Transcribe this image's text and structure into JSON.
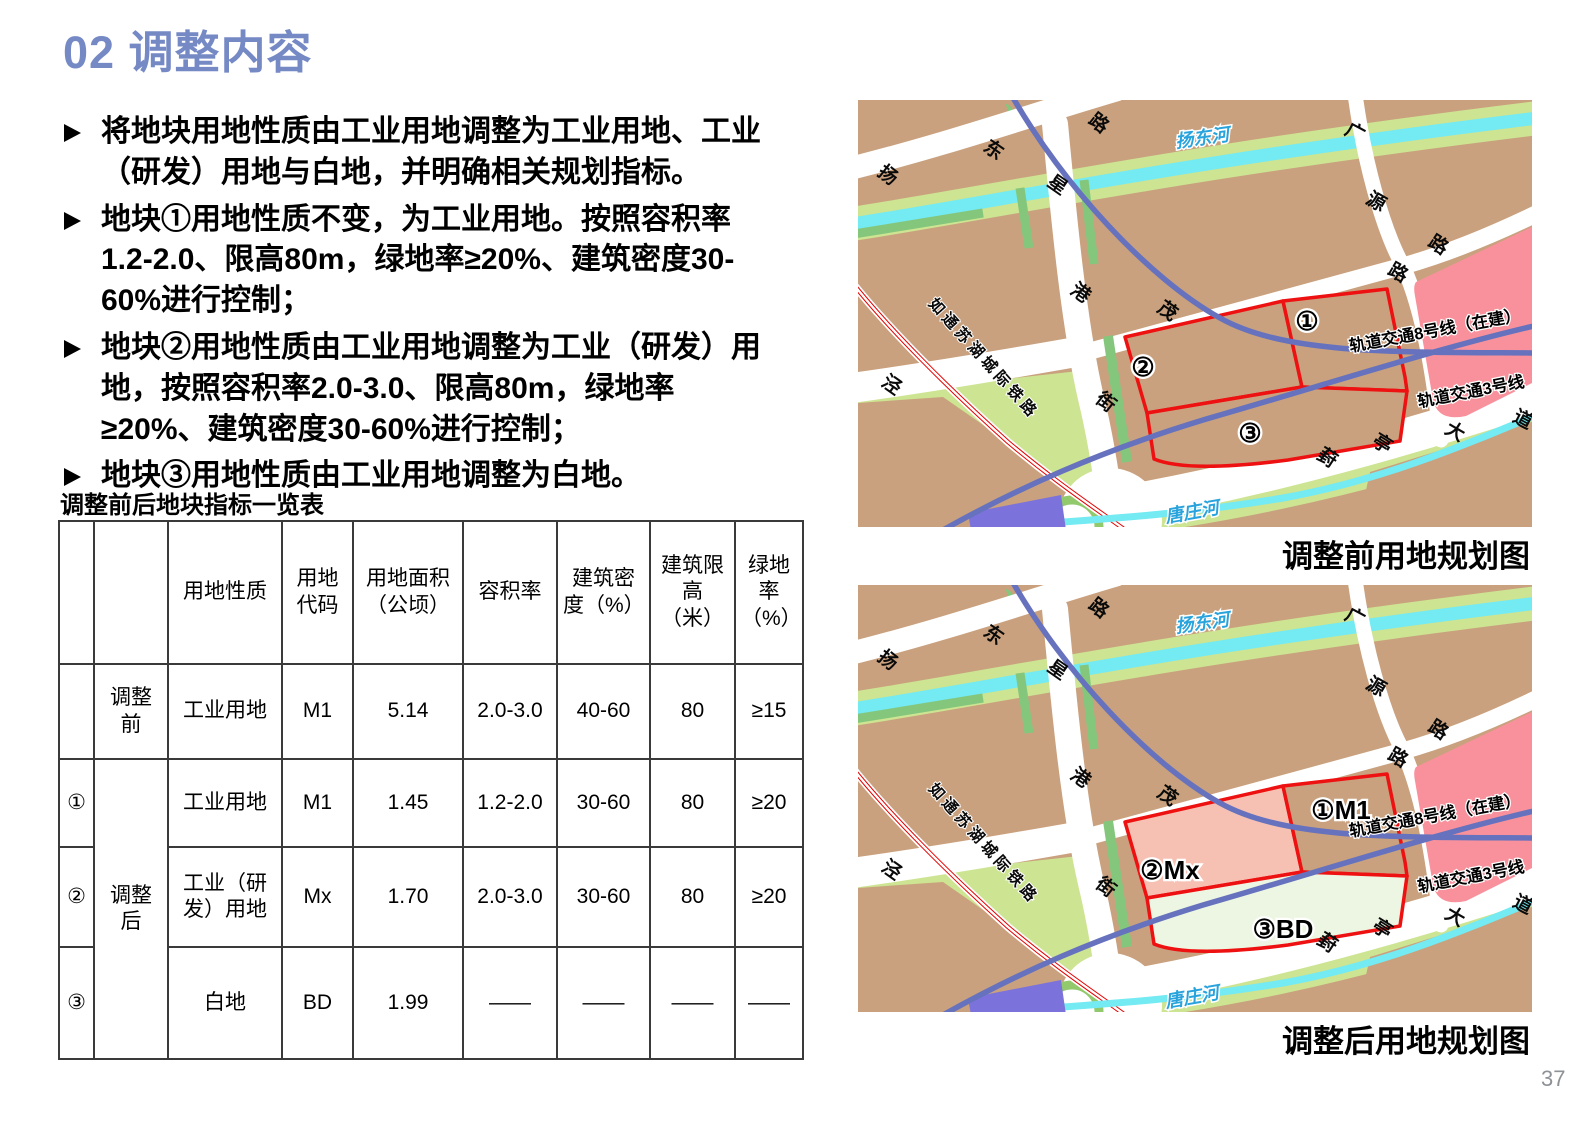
{
  "title": "02 调整内容",
  "bullets": [
    "将地块用地性质由工业用地调整为工业用地、工业（研发）用地与白地，并明确相关规划指标。",
    "地块①用地性质不变，为工业用地。按照容积率1.2-2.0、限高80m，绿地率≥20%、建筑密度30-60%进行控制；",
    "地块②用地性质由工业用地调整为工业（研发）用地，按照容积率2.0-3.0、限高80m，绿地率≥20%、建筑密度30-60%进行控制；",
    "地块③用地性质由工业用地调整为白地。"
  ],
  "table": {
    "title": "调整前后地块指标一览表",
    "headers": [
      "",
      "",
      "用地性质",
      "用地代码",
      "用地面积（公顷）",
      "容积率",
      "建筑密度（%）",
      "建筑限高（米）",
      "绿地率（%）"
    ],
    "rows": [
      {
        "plot": "",
        "phase": "调整前",
        "use": "工业用地",
        "code": "M1",
        "area": "5.14",
        "far": "2.0-3.0",
        "density": "40-60",
        "height": "80",
        "green": "≥15"
      },
      {
        "plot": "①",
        "phase": "调整后",
        "use": "工业用地",
        "code": "M1",
        "area": "1.45",
        "far": "1.2-2.0",
        "density": "30-60",
        "height": "80",
        "green": "≥20"
      },
      {
        "plot": "②",
        "phase": "",
        "use": "工业（研发）用地",
        "code": "Mx",
        "area": "1.70",
        "far": "2.0-3.0",
        "density": "30-60",
        "height": "80",
        "green": "≥20"
      },
      {
        "plot": "③",
        "phase": "",
        "use": "白地",
        "code": "BD",
        "area": "1.99",
        "far": "——",
        "density": "——",
        "height": "——",
        "green": "——"
      }
    ]
  },
  "maps": {
    "before": {
      "caption": "调整前用地规划图",
      "plot_labels": [
        "①",
        "②",
        "③"
      ]
    },
    "after": {
      "caption": "调整后用地规划图",
      "plot_labels": [
        "①M1",
        "②Mx",
        "③BD"
      ]
    },
    "labels": {
      "river_top": "扬东河",
      "river_bottom": "唐庄河",
      "railway": "如通苏湖城际铁路",
      "metro8": "轨道交通8号线（在建）",
      "metro3": "轨道交通3号线",
      "roads": {
        "yangdong": "扬东路",
        "xinggang": "星港街",
        "jing": "泾",
        "mao": "茂",
        "mao_lu": "路",
        "guangyuan": "广源路",
        "fengting": "葑亭大道"
      }
    },
    "colors": {
      "land_tan": "#C9A17E",
      "green_light": "#CDE492",
      "green_dark": "#84C77C",
      "ring_green": "#93C96D",
      "water": "#74EAF2",
      "water_label": "#29A3DC",
      "metro": "#6672BD",
      "railway_red": "#E60000",
      "pink_zone": "#F8919B",
      "plot_outline": "#EE1111",
      "plot2_after": "#F6C1B3",
      "plot3_after": "#EDF6E2",
      "purple": "#7C72DB",
      "road_white": "#FFFFFF"
    }
  },
  "page_number": "37",
  "accent_color": "#7589C5"
}
